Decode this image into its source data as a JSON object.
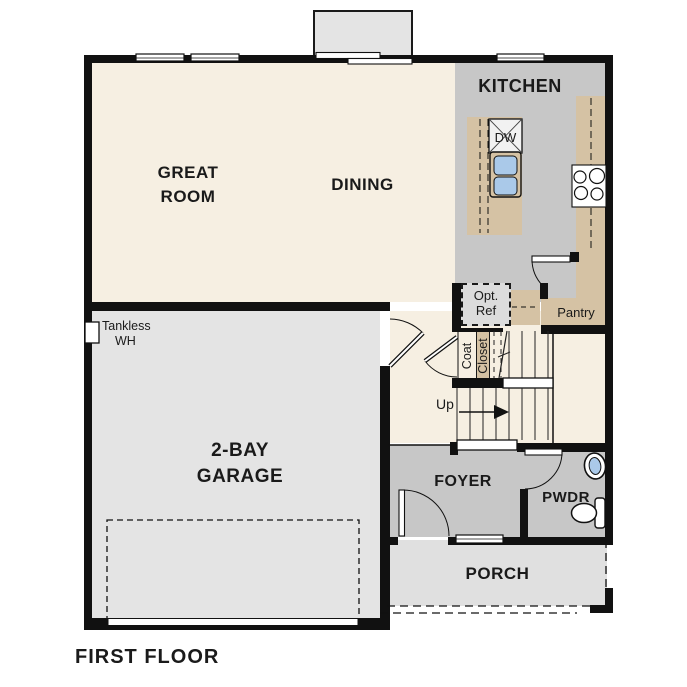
{
  "plan": {
    "title": "FIRST FLOOR",
    "labels": {
      "great_room_1": "GREAT",
      "great_room_2": "ROOM",
      "dining": "DINING",
      "kitchen": "KITCHEN",
      "garage_1": "2-BAY",
      "garage_2": "GARAGE",
      "foyer": "FOYER",
      "pwdr": "PWDR",
      "porch": "PORCH",
      "pantry": "Pantry",
      "opt_ref_1": "Opt.",
      "opt_ref_2": "Ref",
      "coat_1": "Coat",
      "coat_2": "Closet",
      "up": "Up",
      "dw": "DW",
      "tankless_1": "Tankless",
      "tankless_2": "WH"
    },
    "colors": {
      "wall": "#111111",
      "floor_cream": "#f6efe2",
      "kitchen_gray": "#c7c7c7",
      "foyer_gray": "#c7c7c7",
      "garage_gray": "#e4e4e4",
      "porch_gray": "#e0e0e0",
      "counter_tan": "#d5c2a4",
      "fixture_blue": "#aac9e9",
      "optref_gray": "#dcdcdc"
    }
  }
}
